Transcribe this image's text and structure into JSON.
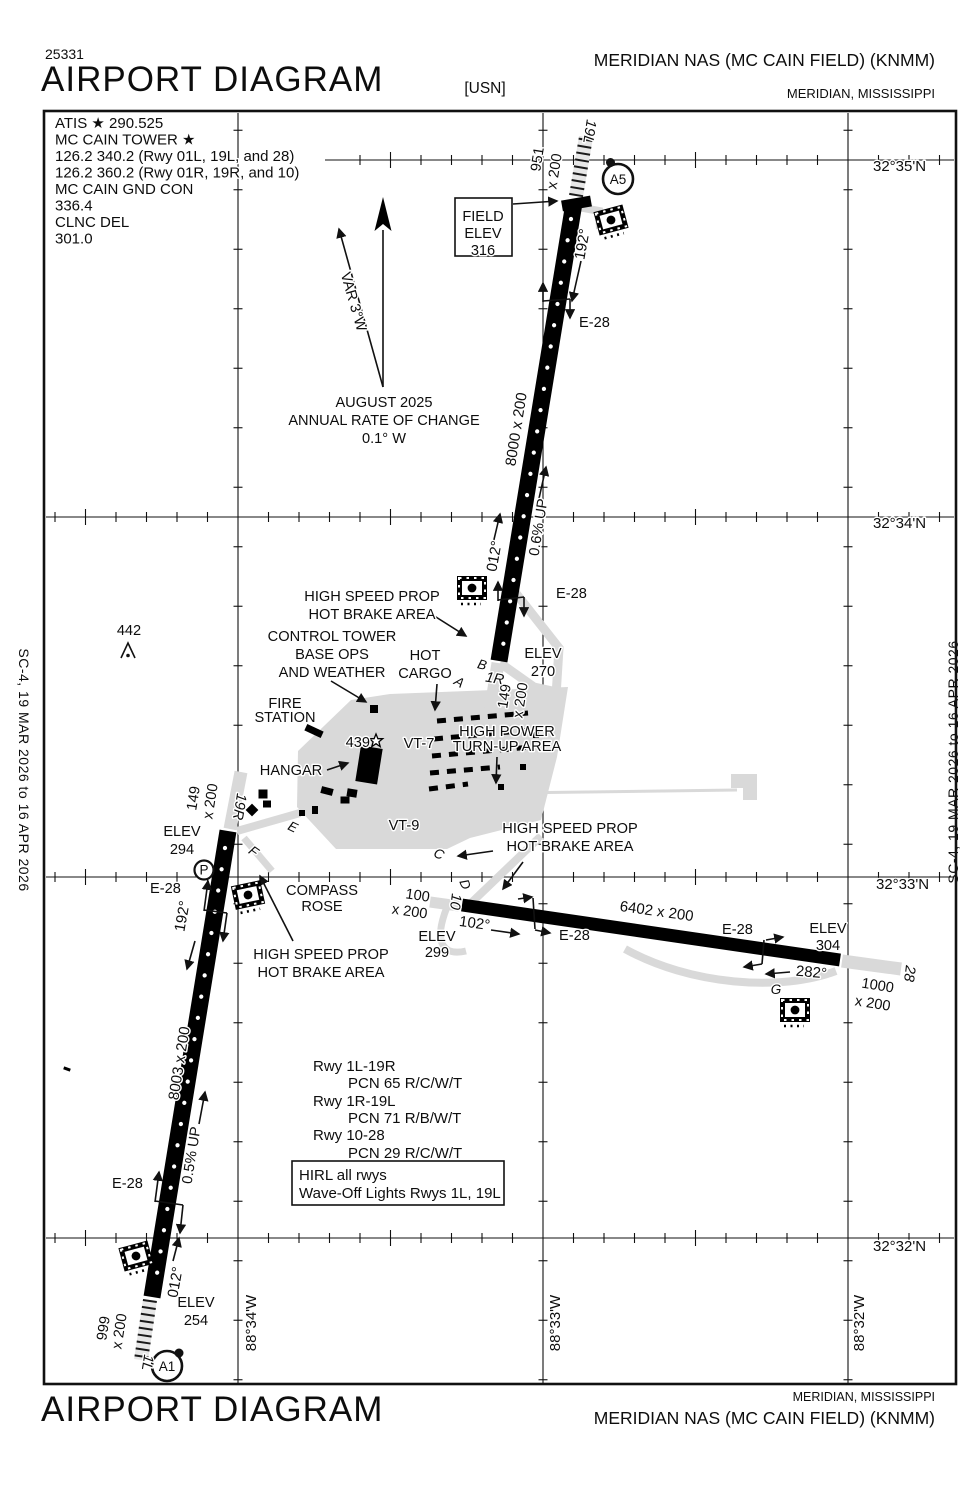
{
  "colors": {
    "ink": "#111111",
    "pavement_gray": "#d9d9d9",
    "runway_black": "#000000"
  },
  "header": {
    "chart_number": "25331",
    "title": "AIRPORT DIAGRAM",
    "classification": "[USN]",
    "airport": "MERIDIAN NAS (MC CAIN FIELD)  (KNMM)",
    "city": "MERIDIAN, MISSISSIPPI"
  },
  "footer": {
    "title": "AIRPORT DIAGRAM",
    "airport": "MERIDIAN NAS (MC CAIN FIELD)  (KNMM)",
    "city": "MERIDIAN, MISSISSIPPI"
  },
  "margin_note": "SC-4,  19 MAR 2026  to  16 APR 2026",
  "comm": {
    "l1": "ATIS ★ 290.525",
    "l2": "MC CAIN TOWER ★",
    "l3": "126.2  340.2 (Rwy 01L, 19L, and 28)",
    "l4": "126.2  360.2 (Rwy 01R, 19R, and 10)",
    "l5": "MC CAIN GND CON",
    "l6": "336.4",
    "l7": "CLNC DEL",
    "l8": "301.0"
  },
  "variation": {
    "var_label": "VAR 3°W",
    "date": "AUGUST 2025",
    "rate1": "ANNUAL RATE OF CHANGE",
    "rate2": "0.1° W"
  },
  "field_elev": {
    "l1": "FIELD",
    "l2": "ELEV",
    "l3": "316"
  },
  "grid": {
    "lat1": "32°35'N",
    "lat2": "32°34'N",
    "lat3": "32°33'N",
    "lat4": "32°32'N",
    "lon1": "88°34'W",
    "lon2": "88°33'W",
    "lon3": "88°32'W"
  },
  "rwy_ne": {
    "num_n": "19L",
    "num_s": "1R",
    "dim": "8000 x 200",
    "grad": "0.6% UP",
    "hdg_s": "192°",
    "hdg_n": "012°",
    "over_n1": "951",
    "over_n2": "x 200",
    "over_s1": "149",
    "over_s2": "x 200",
    "elev_s1": "ELEV",
    "elev_s2": "270"
  },
  "rwy_sw": {
    "num_n": "19R",
    "num_s": "1L",
    "dim": "8003 x 200",
    "grad": "0.5% UP",
    "hdg_s": "192°",
    "hdg_n": "012°",
    "over_n1": "149",
    "over_n2": "x 200",
    "over_s1": "999",
    "over_s2": "x 200",
    "elev_n1": "ELEV",
    "elev_n2": "294",
    "elev_s1": "ELEV",
    "elev_s2": "254"
  },
  "rwy_ew": {
    "num_w": "10",
    "num_e": "28",
    "dim": "6402 x 200",
    "hdg_w": "102°",
    "hdg_e": "282°",
    "over_w1": "100",
    "over_w2": "x 200",
    "over_e1": "1000",
    "over_e2": "x 200",
    "elev_w1": "ELEV",
    "elev_w2": "299",
    "elev_e1": "ELEV",
    "elev_e2": "304"
  },
  "arresting_gear": {
    "label": "E-28"
  },
  "taxiways": {
    "a": "A",
    "b": "B",
    "c": "C",
    "d": "D",
    "e": "E",
    "f": "F",
    "g": "G",
    "a5": "A5",
    "a1": "A1",
    "p": "P"
  },
  "features": {
    "hot_brake1": "HIGH SPEED PROP",
    "hot_brake2": "HOT BRAKE AREA",
    "tower1": "CONTROL TOWER",
    "tower2": "BASE OPS",
    "tower3": "AND WEATHER",
    "cargo1": "HOT",
    "cargo2": "CARGO",
    "fire1": "FIRE",
    "fire2": "STATION",
    "hangar": "HANGAR",
    "power1": "HIGH POWER",
    "power2": "TURN-UP AREA",
    "compass1": "COMPASS",
    "compass2": "ROSE",
    "vt7": "VT-7",
    "vt9": "VT-9",
    "tower_elev": "439",
    "obstruction_elev": "442"
  },
  "pcn": {
    "r1": "Rwy 1L-19R",
    "v1": "PCN 65 R/C/W/T",
    "r2": "Rwy 1R-19L",
    "v2": "PCN 71 R/B/W/T",
    "r3": "Rwy 10-28",
    "v3": "PCN 29 R/C/W/T"
  },
  "lighting": {
    "l1": "HIRL all rwys",
    "l2": "Wave-Off Lights Rwys 1L, 19L"
  }
}
